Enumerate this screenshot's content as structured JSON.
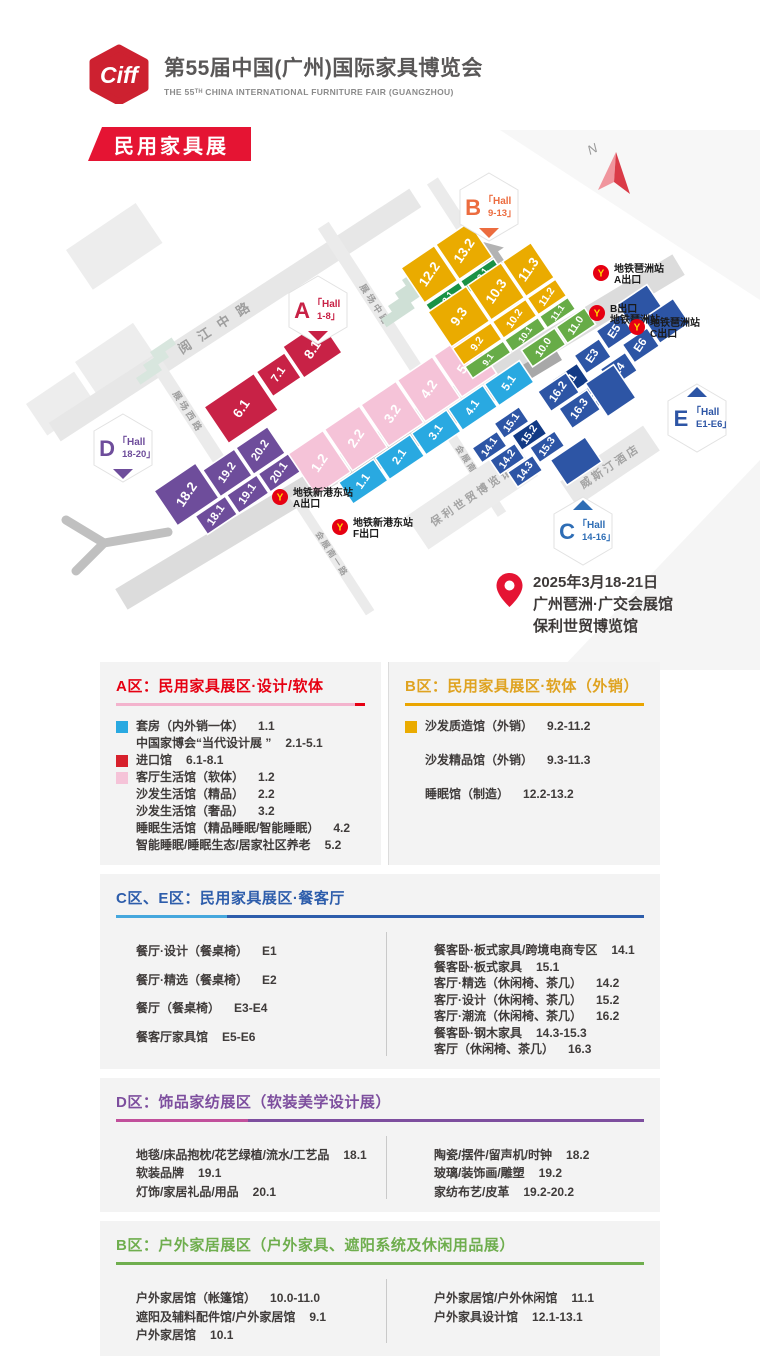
{
  "header": {
    "logo": "Ciff",
    "title": "第55届中国(广州)国际家具博览会",
    "subtitle": "THE 55ᵀᴴ CHINA INTERNATIONAL FURNITURE FAIR (GUANGZHOU)"
  },
  "banner": "民用家具展",
  "venue": {
    "lines": [
      "2025年3月18-21日",
      "广州琶洲·广交会展馆",
      "保利世贸博览馆"
    ]
  },
  "map": {
    "north": {
      "label": "N",
      "x": 612,
      "y": 45
    },
    "badges": [
      {
        "letter": "A",
        "range": "1-8",
        "color": "#c82246",
        "x": 318,
        "y": 180,
        "pointer": "down"
      },
      {
        "letter": "B",
        "range": "9-13",
        "color": "#ec6c3f",
        "x": 489,
        "y": 77,
        "pointer": "down"
      },
      {
        "letter": "C",
        "range": "14-16",
        "color": "#2e6db5",
        "x": 583,
        "y": 401,
        "pointer": "up"
      },
      {
        "letter": "D",
        "range": "18-20",
        "color": "#6e4d9b",
        "x": 123,
        "y": 318,
        "pointer": "down"
      },
      {
        "letter": "E",
        "range": "E1-E6",
        "color": "#2d55a5",
        "x": 697,
        "y": 288,
        "pointer": "up"
      }
    ],
    "roads": [
      {
        "label": "阅江中路",
        "x": 235,
        "y": 185,
        "angle": -33,
        "len": 430,
        "w": 22,
        "fill": "#e7e7e7",
        "fs": 13,
        "ls": 10,
        "dx": -20,
        "dy": 4
      },
      {
        "label": "展场西路",
        "x": 188,
        "y": 282,
        "angle": 57,
        "len": 130,
        "w": 13,
        "fill": "#ebebeb",
        "fs": 9,
        "ls": 3,
        "dx": 0,
        "dy": 3
      },
      {
        "label": "展场中路",
        "x": 375,
        "y": 175,
        "angle": 57,
        "len": 190,
        "w": 13,
        "fill": "#ebebeb",
        "fs": 9,
        "ls": 3,
        "dx": 0,
        "dy": 3
      },
      {
        "label": "展场东路",
        "x": 476,
        "y": 118,
        "angle": 57,
        "len": 160,
        "w": 13,
        "fill": "#ebebeb",
        "fs": 9,
        "ls": 3,
        "dx": 0,
        "dy": 3
      },
      {
        "label": "新港东路",
        "x": 400,
        "y": 302,
        "angle": -31,
        "len": 650,
        "w": 24,
        "fill": "#dcdcdc",
        "fs": 14,
        "ls": 12,
        "dx": 0,
        "dy": 24
      },
      {
        "label": "会展南二路",
        "x": 472,
        "y": 338,
        "angle": 57,
        "len": 110,
        "w": 10,
        "fill": "#ebebeb",
        "fs": 8.5,
        "ls": 2,
        "dx": 0,
        "dy": 3
      },
      {
        "label": "会展南一路",
        "x": 332,
        "y": 424,
        "angle": 57,
        "len": 140,
        "w": 10,
        "fill": "#ebebeb",
        "fs": 8.5,
        "ls": 2,
        "dx": 0,
        "dy": 3
      }
    ],
    "buildings": [
      {
        "label": "保利世贸博览馆",
        "x": 472,
        "y": 366,
        "rot": -34,
        "w": 132,
        "h": 40,
        "fill": "#ececec",
        "fs": 11
      },
      {
        "label": "威斯汀酒店",
        "x": 610,
        "y": 336,
        "rot": -34,
        "w": 100,
        "h": 30,
        "fill": "#e8e8e8",
        "fs": 11
      }
    ],
    "stations": [
      {
        "lines": [
          "地铁琶洲站",
          "A出口"
        ],
        "x": 601,
        "y": 143
      },
      {
        "lines": [
          "B出口",
          "地铁琶洲站"
        ],
        "x": 597,
        "y": 183
      },
      {
        "lines": [
          "地铁琶洲站",
          "C出口"
        ],
        "x": 637,
        "y": 197
      },
      {
        "lines": [
          "地铁新港东站",
          "A出口"
        ],
        "x": 280,
        "y": 367
      },
      {
        "lines": [
          "地铁新港东站",
          "F出口"
        ],
        "x": 340,
        "y": 397
      }
    ],
    "groups": [
      {
        "id": "red-import",
        "x": 204,
        "y": 277,
        "rot": -34,
        "color": "#c82246",
        "halls": [
          {
            "l": "6.1",
            "x": 0,
            "y": 0,
            "w": 60,
            "h": 44
          },
          {
            "l": "7.1",
            "x": 63,
            "y": 0,
            "w": 34,
            "h": 30
          },
          {
            "l": "8.1",
            "x": 99,
            "y": -6,
            "w": 46,
            "h": 38
          }
        ]
      },
      {
        "id": "pink-blue",
        "x": 288,
        "y": 324,
        "rot": -34,
        "color": "#f5c3d8",
        "halls": [
          {
            "l": "1.2",
            "x": 0,
            "y": 0,
            "w": 42,
            "h": 50
          },
          {
            "l": "2.2",
            "x": 44,
            "y": 0,
            "w": 42,
            "h": 50
          },
          {
            "l": "3.2",
            "x": 88,
            "y": 0,
            "w": 42,
            "h": 50
          },
          {
            "l": "4.2",
            "x": 132,
            "y": 0,
            "w": 42,
            "h": 50
          },
          {
            "l": "5.2",
            "x": 176,
            "y": 0,
            "w": 42,
            "h": 50
          },
          {
            "l": "1.1",
            "x": 26,
            "y": 52,
            "w": 42,
            "h": 26,
            "c": "#29a9e1"
          },
          {
            "l": "2.1",
            "x": 70,
            "y": 52,
            "w": 42,
            "h": 26,
            "c": "#29a9e1"
          },
          {
            "l": "3.1",
            "x": 114,
            "y": 52,
            "w": 42,
            "h": 26,
            "c": "#29a9e1"
          },
          {
            "l": "4.1",
            "x": 158,
            "y": 52,
            "w": 42,
            "h": 26,
            "c": "#29a9e1"
          },
          {
            "l": "5.1",
            "x": 202,
            "y": 52,
            "w": 42,
            "h": 26,
            "c": "#29a9e1"
          }
        ]
      },
      {
        "id": "purple-d",
        "x": 154,
        "y": 361,
        "rot": -34,
        "color": "#6e4d9b",
        "halls": [
          {
            "l": "18.2",
            "x": 0,
            "y": 0,
            "w": 50,
            "h": 42
          },
          {
            "l": "19.2",
            "x": 52,
            "y": 10,
            "w": 38,
            "h": 32
          },
          {
            "l": "20.2",
            "x": 92,
            "y": 10,
            "w": 38,
            "h": 32
          },
          {
            "l": "18.1",
            "x": 20,
            "y": 44,
            "w": 36,
            "h": 22
          },
          {
            "l": "19.1",
            "x": 58,
            "y": 44,
            "w": 36,
            "h": 22
          },
          {
            "l": "20.1",
            "x": 96,
            "y": 44,
            "w": 36,
            "h": 22
          }
        ]
      },
      {
        "id": "yellow-12-13",
        "x": 401,
        "y": 138,
        "rot": -34,
        "color": "#eaab00",
        "halls": [
          {
            "l": "12.2",
            "x": 0,
            "y": 0,
            "w": 40,
            "h": 42
          },
          {
            "l": "13.2",
            "x": 42,
            "y": 0,
            "w": 40,
            "h": 42
          },
          {
            "l": "12.1",
            "x": 0,
            "y": 44,
            "w": 40,
            "h": 15,
            "c": "#199245"
          },
          {
            "l": "13.1",
            "x": 42,
            "y": 44,
            "w": 40,
            "h": 15,
            "c": "#199245"
          }
        ]
      },
      {
        "id": "yellow-9-11",
        "x": 428,
        "y": 182,
        "rot": -34,
        "color": "#eaab00",
        "halls": [
          {
            "l": "9.3",
            "x": 0,
            "y": 0,
            "w": 46,
            "h": 42
          },
          {
            "l": "10.3",
            "x": 48,
            "y": 0,
            "w": 40,
            "h": 42
          },
          {
            "l": "11.3",
            "x": 90,
            "y": 0,
            "w": 34,
            "h": 42
          },
          {
            "l": "9.2",
            "x": 0,
            "y": 44,
            "w": 46,
            "h": 20
          },
          {
            "l": "10.2",
            "x": 48,
            "y": 44,
            "w": 40,
            "h": 20
          },
          {
            "l": "11.2",
            "x": 90,
            "y": 44,
            "w": 34,
            "h": 20
          },
          {
            "l": "9.1",
            "x": 0,
            "y": 66,
            "w": 46,
            "h": 14,
            "c": "#67ac47"
          },
          {
            "l": "10.1",
            "x": 48,
            "y": 66,
            "w": 40,
            "h": 14,
            "c": "#67ac47"
          },
          {
            "l": "11.1",
            "x": 90,
            "y": 66,
            "w": 34,
            "h": 14,
            "c": "#67ac47"
          },
          {
            "l": "10.0",
            "x": 56,
            "y": 84,
            "w": 40,
            "h": 20,
            "c": "#67ac47"
          },
          {
            "l": "11.0",
            "x": 98,
            "y": 84,
            "w": 34,
            "h": 20,
            "c": "#67ac47"
          }
        ]
      },
      {
        "id": "e-halls",
        "x": 552,
        "y": 250,
        "rot": -34,
        "color": "#2d55a5",
        "halls": [
          {
            "l": "E1",
            "x": 0,
            "y": 0,
            "w": 30,
            "h": 22,
            "c": "#123a85"
          },
          {
            "l": "E3",
            "x": 32,
            "y": -8,
            "w": 30,
            "h": 22
          },
          {
            "l": "E5",
            "x": 64,
            "y": -16,
            "w": 30,
            "h": 22
          },
          {
            "l": "",
            "x": 96,
            "y": -26,
            "w": 36,
            "h": 30
          },
          {
            "l": "E2",
            "x": 14,
            "y": 26,
            "w": 30,
            "h": 22
          },
          {
            "l": "E4",
            "x": 46,
            "y": 18,
            "w": 30,
            "h": 22
          },
          {
            "l": "E6",
            "x": 78,
            "y": 10,
            "w": 30,
            "h": 22
          },
          {
            "l": "",
            "x": 110,
            "y": 0,
            "w": 36,
            "h": 30
          }
        ]
      },
      {
        "id": "c-halls",
        "x": 472,
        "y": 318,
        "rot": -34,
        "color": "#2d55a5",
        "halls": [
          {
            "l": "16.2",
            "x": 86,
            "y": -10,
            "w": 34,
            "h": 24
          },
          {
            "l": "16.3",
            "x": 94,
            "y": 16,
            "w": 34,
            "h": 24
          },
          {
            "l": "",
            "x": 130,
            "y": 10,
            "w": 34,
            "h": 40
          },
          {
            "l": "14.1",
            "x": 0,
            "y": 0,
            "w": 30,
            "h": 18
          },
          {
            "l": "15.1",
            "x": 32,
            "y": -8,
            "w": 30,
            "h": 18
          },
          {
            "l": "14.2",
            "x": 8,
            "y": 20,
            "w": 30,
            "h": 18
          },
          {
            "l": "15.2",
            "x": 40,
            "y": 12,
            "w": 30,
            "h": 18,
            "c": "#123a85"
          },
          {
            "l": "14.3",
            "x": 16,
            "y": 40,
            "w": 30,
            "h": 18
          },
          {
            "l": "15.3",
            "x": 48,
            "y": 32,
            "w": 30,
            "h": 18
          },
          {
            "l": "",
            "x": 58,
            "y": 54,
            "w": 42,
            "h": 30
          }
        ]
      }
    ]
  },
  "sections": [
    {
      "id": "a",
      "title": "A区：民用家具展区·设计/软体",
      "color": "#e60012",
      "underline": [
        "#f3b3cd",
        "#e60012"
      ],
      "split": 96,
      "items": [
        {
          "swatch": "#29a9e1",
          "label": "套房（内外销一体）",
          "code": "1.1"
        },
        {
          "label": "中国家博会“当代设计展 ”",
          "code": "2.1-5.1"
        },
        {
          "swatch": "#d7202c",
          "label": "进口馆",
          "code": "6.1-8.1"
        },
        {
          "swatch": "#f5c3d8",
          "label": "客厅生活馆（软体）",
          "code": "1.2"
        },
        {
          "label": "沙发生活馆（精品）",
          "code": "2.2"
        },
        {
          "label": "沙发生活馆（奢品）",
          "code": "3.2"
        },
        {
          "label": "睡眠生活馆（精品睡眠/智能睡眠）",
          "code": "4.2"
        },
        {
          "label": "智能睡眠/睡眠生态/居家社区养老",
          "code": "5.2"
        }
      ]
    },
    {
      "id": "b-soft",
      "title": "B区：民用家具展区·软体（外销）",
      "color": "#dfa321",
      "underline": [
        "#eaa500"
      ],
      "items": [
        {
          "swatch": "#eaab00",
          "label": "沙发质造馆（外销）",
          "code": "9.2-11.2"
        },
        {
          "label": "沙发精品馆（外销）",
          "code": "9.3-11.3"
        },
        {
          "label": "睡眠馆（制造）",
          "code": "12.2-13.2"
        }
      ]
    },
    {
      "id": "ce",
      "title": "C区、E区：民用家具展区·餐客厅",
      "color": "#2d5dab",
      "underline": [
        "#45a7dd",
        "#2d5dab"
      ],
      "split": 21,
      "columns": {
        "left": [
          {
            "label": "餐厅·设计（餐桌椅）",
            "code": "E1"
          },
          {
            "label": "餐厅·精选（餐桌椅）",
            "code": "E2"
          },
          {
            "label": "餐厅（餐桌椅）",
            "code": "E3-E4"
          },
          {
            "label": "餐客厅家具馆",
            "code": "E5-E6"
          }
        ],
        "right": [
          {
            "label": "餐客卧·板式家具/跨境电商专区",
            "code": "14.1"
          },
          {
            "label": "餐客卧·板式家具",
            "code": "15.1"
          },
          {
            "label": "客厅·精选（休闲椅、茶几）",
            "code": "14.2"
          },
          {
            "label": "客厅·设计（休闲椅、茶几）",
            "code": "15.2"
          },
          {
            "label": "客厅·潮流（休闲椅、茶几）",
            "code": "16.2"
          },
          {
            "label": "餐客卧·钢木家具",
            "code": "14.3-15.3"
          },
          {
            "label": "客厅（休闲椅、茶几）",
            "code": "16.3"
          }
        ]
      }
    },
    {
      "id": "d",
      "title": "D区：饰品家纺展区（软装美学设计展）",
      "color": "#7d4e9e",
      "underline": [
        "#c14f9b",
        "#7d4e9e"
      ],
      "split": 25,
      "columns": {
        "left": [
          {
            "label": "地毯/床品抱枕/花艺绿植/流水/工艺品",
            "code": "18.1"
          },
          {
            "label": "软装品牌",
            "code": "19.1"
          },
          {
            "label": "灯饰/家居礼品/用品",
            "code": "20.1"
          }
        ],
        "right": [
          {
            "label": "陶瓷/摆件/留声机/时钟",
            "code": "18.2"
          },
          {
            "label": "玻璃/装饰画/雕塑",
            "code": "19.2"
          },
          {
            "label": "家纺布艺/皮革",
            "code": "19.2-20.2"
          }
        ]
      }
    },
    {
      "id": "b-outdoor",
      "title": "B区：户外家居展区（户外家具、遮阳系统及休闲用品展）",
      "color": "#6fae4e",
      "underline": [
        "#6fae4e"
      ],
      "columns": {
        "left": [
          {
            "label": "户外家居馆（帐篷馆）",
            "code": "10.0-11.0"
          },
          {
            "label": "遮阳及辅料配件馆/户外家居馆",
            "code": "9.1"
          },
          {
            "label": "户外家居馆",
            "code": "10.1"
          }
        ],
        "right": [
          {
            "label": "户外家居馆/户外休闲馆",
            "code": "11.1"
          },
          {
            "label": "户外家具设计馆",
            "code": "12.1-13.1"
          }
        ]
      }
    }
  ]
}
